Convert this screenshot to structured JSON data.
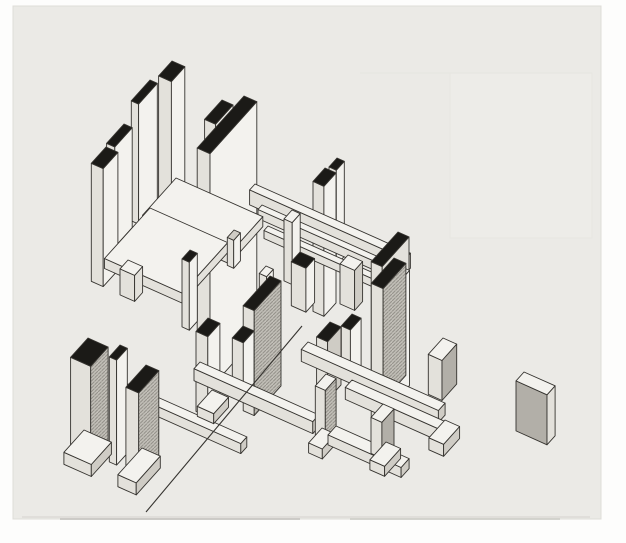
{
  "figure": {
    "kind": "scanned-axonometric-architectural-drawing",
    "canvas": {
      "width": 626,
      "height": 543
    },
    "photo_area": {
      "x": 13,
      "y": 6,
      "width": 588,
      "height": 513
    }
  },
  "palette": {
    "paper": "#fdfdfc",
    "photo": "#ebeae6",
    "photo_edge": "#deddd8",
    "line": "#35332f",
    "black": "#1b1a17",
    "white": "#f3f2ee",
    "light": "#e3e1db",
    "mid": "#cfccc5",
    "gray": "#b2afa8",
    "hatch_bg": "#c2bfb8",
    "hatch_line": "#94918a",
    "faint": "#e7e6e1",
    "faint_fill": "#edece8",
    "smudge": "#cfcec9",
    "smudge_dark": "#c6c5c0"
  },
  "drawing": {
    "projection": {
      "ax": 0.914,
      "ay": 0.407,
      "bx": -0.669,
      "by": 0.743
    },
    "faint_artifacts": {
      "rect": {
        "x1": 450,
        "y1": 73,
        "x2": 592,
        "y2": 238
      },
      "hline": {
        "x1": 360,
        "y1": 73,
        "x2": 592,
        "y2": 73
      }
    },
    "smudges": [
      {
        "x1": 22,
        "y1": 517,
        "x2": 590,
        "y2": 517,
        "w": 1,
        "key": "smudge"
      },
      {
        "x1": 60,
        "y1": 519,
        "x2": 300,
        "y2": 519,
        "w": 2,
        "key": "smudge_dark"
      },
      {
        "x1": 350,
        "y1": 519,
        "x2": 560,
        "y2": 519,
        "w": 2,
        "key": "smudge"
      }
    ],
    "elements": [
      {
        "type": "box",
        "name": "pier-tl-tall",
        "n": [
          172,
          61
        ],
        "a": 14,
        "b": 20,
        "h": 150,
        "top": "black",
        "left": "light",
        "right": "white"
      },
      {
        "type": "box",
        "name": "slab-tl-thin",
        "n": [
          150,
          80
        ],
        "a": 8,
        "b": 28,
        "h": 120,
        "top": "black",
        "left": "light",
        "right": "white"
      },
      {
        "type": "box",
        "name": "slab-center-step",
        "n": [
          222,
          100
        ],
        "a": 12,
        "b": 26,
        "h": 58,
        "top": "black",
        "left": "light",
        "right": "white"
      },
      {
        "type": "box",
        "name": "slab-tl-mid",
        "n": [
          124,
          124
        ],
        "a": 9,
        "b": 26,
        "h": 100,
        "top": "black",
        "left": "light",
        "right": "white"
      },
      {
        "type": "box",
        "name": "slab-center-main",
        "n": [
          244,
          96
        ],
        "a": 14,
        "b": 70,
        "h": 235,
        "top": "black",
        "left": "light",
        "right": "white"
      },
      {
        "type": "box",
        "name": "pier-tl-left",
        "n": [
          106,
          147
        ],
        "a": 13,
        "b": 22,
        "h": 118,
        "top": "black",
        "left": "light",
        "right": "white"
      },
      {
        "type": "box",
        "name": "pier-upper-right-back",
        "n": [
          337,
          158
        ],
        "a": 8,
        "b": 12,
        "h": 95,
        "top": "black",
        "left": "light",
        "right": "white"
      },
      {
        "type": "box",
        "name": "pier-upper-right",
        "n": [
          325,
          168
        ],
        "a": 12,
        "b": 18,
        "h": 130,
        "top": "black",
        "left": "light",
        "right": "white"
      },
      {
        "type": "box",
        "name": "beam-upper-long",
        "n": [
          255,
          184
        ],
        "a": 170,
        "b": 8,
        "h": 15,
        "top": "white",
        "left": "light",
        "right": "mid"
      },
      {
        "type": "box",
        "name": "beam-upper-thin",
        "n": [
          262,
          205
        ],
        "a": 150,
        "b": 6,
        "h": 9,
        "top": "white",
        "left": "light",
        "right": "light"
      },
      {
        "type": "box",
        "name": "beam-lower-thin",
        "n": [
          268,
          226
        ],
        "a": 135,
        "b": 6,
        "h": 8,
        "top": "white",
        "left": "light",
        "right": "light"
      },
      {
        "type": "box",
        "name": "post-center",
        "n": [
          292,
          210
        ],
        "a": 9,
        "b": 12,
        "h": 62,
        "top": "white",
        "left": "light",
        "right": "white"
      },
      {
        "type": "box",
        "name": "plate-upper",
        "n": [
          176,
          178
        ],
        "a": 95,
        "b": 50,
        "h": 10,
        "top": "white",
        "left": "light",
        "right": "light"
      },
      {
        "type": "box",
        "name": "plate-lower",
        "n": [
          150,
          208
        ],
        "a": 85,
        "b": 68,
        "h": 10,
        "top": "white",
        "left": "light",
        "right": "light"
      },
      {
        "type": "box",
        "name": "slab-right-tall",
        "n": [
          398,
          232
        ],
        "a": 12,
        "b": 40,
        "h": 160,
        "top": "black",
        "left": "light",
        "right": "light"
      },
      {
        "type": "box",
        "name": "fin-plate-edge",
        "n": [
          234,
          230
        ],
        "a": 7,
        "b": 10,
        "h": 28,
        "top": "mid",
        "left": "light",
        "right": "white"
      },
      {
        "type": "box",
        "name": "fin-center-left",
        "n": [
          190,
          250
        ],
        "a": 8,
        "b": 12,
        "h": 68,
        "top": "black",
        "left": "light",
        "right": "white"
      },
      {
        "type": "box",
        "name": "cube-left",
        "n": [
          128,
          260
        ],
        "a": 16,
        "b": 12,
        "h": 26,
        "top": "white",
        "left": "light",
        "right": "light"
      },
      {
        "type": "box",
        "name": "block-center-capped",
        "n": [
          300,
          252
        ],
        "a": 16,
        "b": 13,
        "h": 44,
        "top": "black",
        "left": "light",
        "right": "white"
      },
      {
        "type": "box",
        "name": "block-center-right",
        "n": [
          348,
          255
        ],
        "a": 16,
        "b": 12,
        "h": 40,
        "top": "white",
        "left": "light",
        "right": "mid"
      },
      {
        "type": "box",
        "name": "fin-center-small",
        "n": [
          266,
          266
        ],
        "a": 8,
        "b": 10,
        "h": 55,
        "top": "white",
        "left": "light",
        "right": "white"
      },
      {
        "type": "box",
        "name": "slab-center-shaded",
        "n": [
          270,
          276
        ],
        "a": 12,
        "b": 40,
        "h": 105,
        "top": "black",
        "left": "light",
        "right": "hatch"
      },
      {
        "type": "box",
        "name": "slab-mid-pair-back",
        "n": [
          352,
          314
        ],
        "a": 10,
        "b": 16,
        "h": 52,
        "top": "black",
        "left": "light",
        "right": "white"
      },
      {
        "type": "box",
        "name": "slab-mid-pair-front",
        "n": [
          330,
          322
        ],
        "a": 12,
        "b": 20,
        "h": 58,
        "top": "black",
        "left": "light",
        "right": "mid"
      },
      {
        "type": "box",
        "name": "slab-right-thin-back",
        "n": [
          404,
          268
        ],
        "a": 6,
        "b": 20,
        "h": 115,
        "top": "white",
        "left": "light",
        "right": "white"
      },
      {
        "type": "box",
        "name": "slab-right-shaded",
        "n": [
          394,
          258
        ],
        "a": 13,
        "b": 34,
        "h": 112,
        "top": "black",
        "left": "light",
        "right": "hatch"
      },
      {
        "type": "box",
        "name": "beam-ground-right-upper",
        "n": [
          308,
          342
        ],
        "a": 150,
        "b": 10,
        "h": 12,
        "top": "white",
        "left": "light",
        "right": "mid"
      },
      {
        "type": "box",
        "name": "pier-bottom-center-left",
        "n": [
          208,
          318
        ],
        "a": 13,
        "b": 18,
        "h": 80,
        "top": "black",
        "left": "light",
        "right": "white"
      },
      {
        "type": "box",
        "name": "pier-bottom-center-right",
        "n": [
          243,
          326
        ],
        "a": 12,
        "b": 16,
        "h": 58,
        "top": "black",
        "left": "light",
        "right": "white"
      },
      {
        "type": "box",
        "name": "beam-ground-center",
        "n": [
          200,
          362
        ],
        "a": 130,
        "b": 9,
        "h": 12,
        "top": "white",
        "left": "light",
        "right": "mid"
      },
      {
        "type": "box",
        "name": "beam-ground-left",
        "n": [
          128,
          384
        ],
        "a": 130,
        "b": 9,
        "h": 10,
        "top": "white",
        "left": "light",
        "right": "mid"
      },
      {
        "type": "box",
        "name": "beam-ground-right-lower",
        "n": [
          352,
          380
        ],
        "a": 110,
        "b": 10,
        "h": 12,
        "top": "white",
        "left": "light",
        "right": "mid"
      },
      {
        "type": "line",
        "name": "ground-diagonal-line",
        "x1": 302,
        "y1": 326,
        "x2": 146,
        "y2": 512,
        "w": 1.1,
        "key": "line"
      },
      {
        "type": "box",
        "name": "slab-bl-thin",
        "n": [
          120,
          345
        ],
        "a": 8,
        "b": 16,
        "h": 105,
        "top": "black",
        "left": "light",
        "right": "white"
      },
      {
        "type": "box",
        "name": "slab-bl-shaded-left",
        "n": [
          88,
          338
        ],
        "a": 22,
        "b": 26,
        "h": 95,
        "top": "black",
        "left": "light",
        "right": "hatch"
      },
      {
        "type": "box",
        "name": "slab-bl-shaded-right",
        "n": [
          146,
          365
        ],
        "a": 14,
        "b": 30,
        "h": 92,
        "top": "black",
        "left": "light",
        "right": "hatch"
      },
      {
        "type": "box",
        "name": "plinth-bottom-center",
        "n": [
          212,
          390
        ],
        "a": 18,
        "b": 22,
        "h": 10,
        "top": "white",
        "left": "light",
        "right": "mid"
      },
      {
        "type": "box",
        "name": "pier-br-shaded",
        "n": [
          326,
          374
        ],
        "a": 11,
        "b": 16,
        "h": 58,
        "top": "white",
        "left": "light",
        "right": "hatch"
      },
      {
        "type": "box",
        "name": "plinth-br-left",
        "n": [
          322,
          428
        ],
        "a": 15,
        "b": 20,
        "h": 10,
        "top": "white",
        "left": "light",
        "right": "mid"
      },
      {
        "type": "box",
        "name": "beam-plinth-bar",
        "n": [
          336,
          426
        ],
        "a": 80,
        "b": 12,
        "h": 10,
        "top": "white",
        "left": "light",
        "right": "mid"
      },
      {
        "type": "box",
        "name": "block-right-small",
        "n": [
          443,
          338
        ],
        "a": 15,
        "b": 22,
        "h": 40,
        "top": "white",
        "left": "light",
        "right": "gray"
      },
      {
        "type": "box",
        "name": "plinth-right-small",
        "n": [
          445,
          420
        ],
        "a": 16,
        "b": 24,
        "h": 12,
        "top": "white",
        "left": "light",
        "right": "mid"
      },
      {
        "type": "box",
        "name": "pier-br-front",
        "n": [
          383,
          404
        ],
        "a": 12,
        "b": 18,
        "h": 36,
        "top": "white",
        "left": "light",
        "right": "gray"
      },
      {
        "type": "box",
        "name": "plinth-br-front",
        "n": [
          386,
          442
        ],
        "a": 16,
        "b": 24,
        "h": 10,
        "top": "white",
        "left": "light",
        "right": "mid"
      },
      {
        "type": "box",
        "name": "plinth-bl-left",
        "n": [
          84,
          430
        ],
        "a": 30,
        "b": 30,
        "h": 12,
        "top": "white",
        "left": "light",
        "right": "mid"
      },
      {
        "type": "box",
        "name": "plinth-bl-right",
        "n": [
          142,
          448
        ],
        "a": 20,
        "b": 36,
        "h": 12,
        "top": "white",
        "left": "light",
        "right": "mid"
      },
      {
        "type": "box",
        "name": "isolated-block",
        "n": [
          524,
          372
        ],
        "a": 34,
        "b": 12,
        "h": 50,
        "top": "white",
        "left": "gray",
        "right": "light"
      }
    ]
  }
}
